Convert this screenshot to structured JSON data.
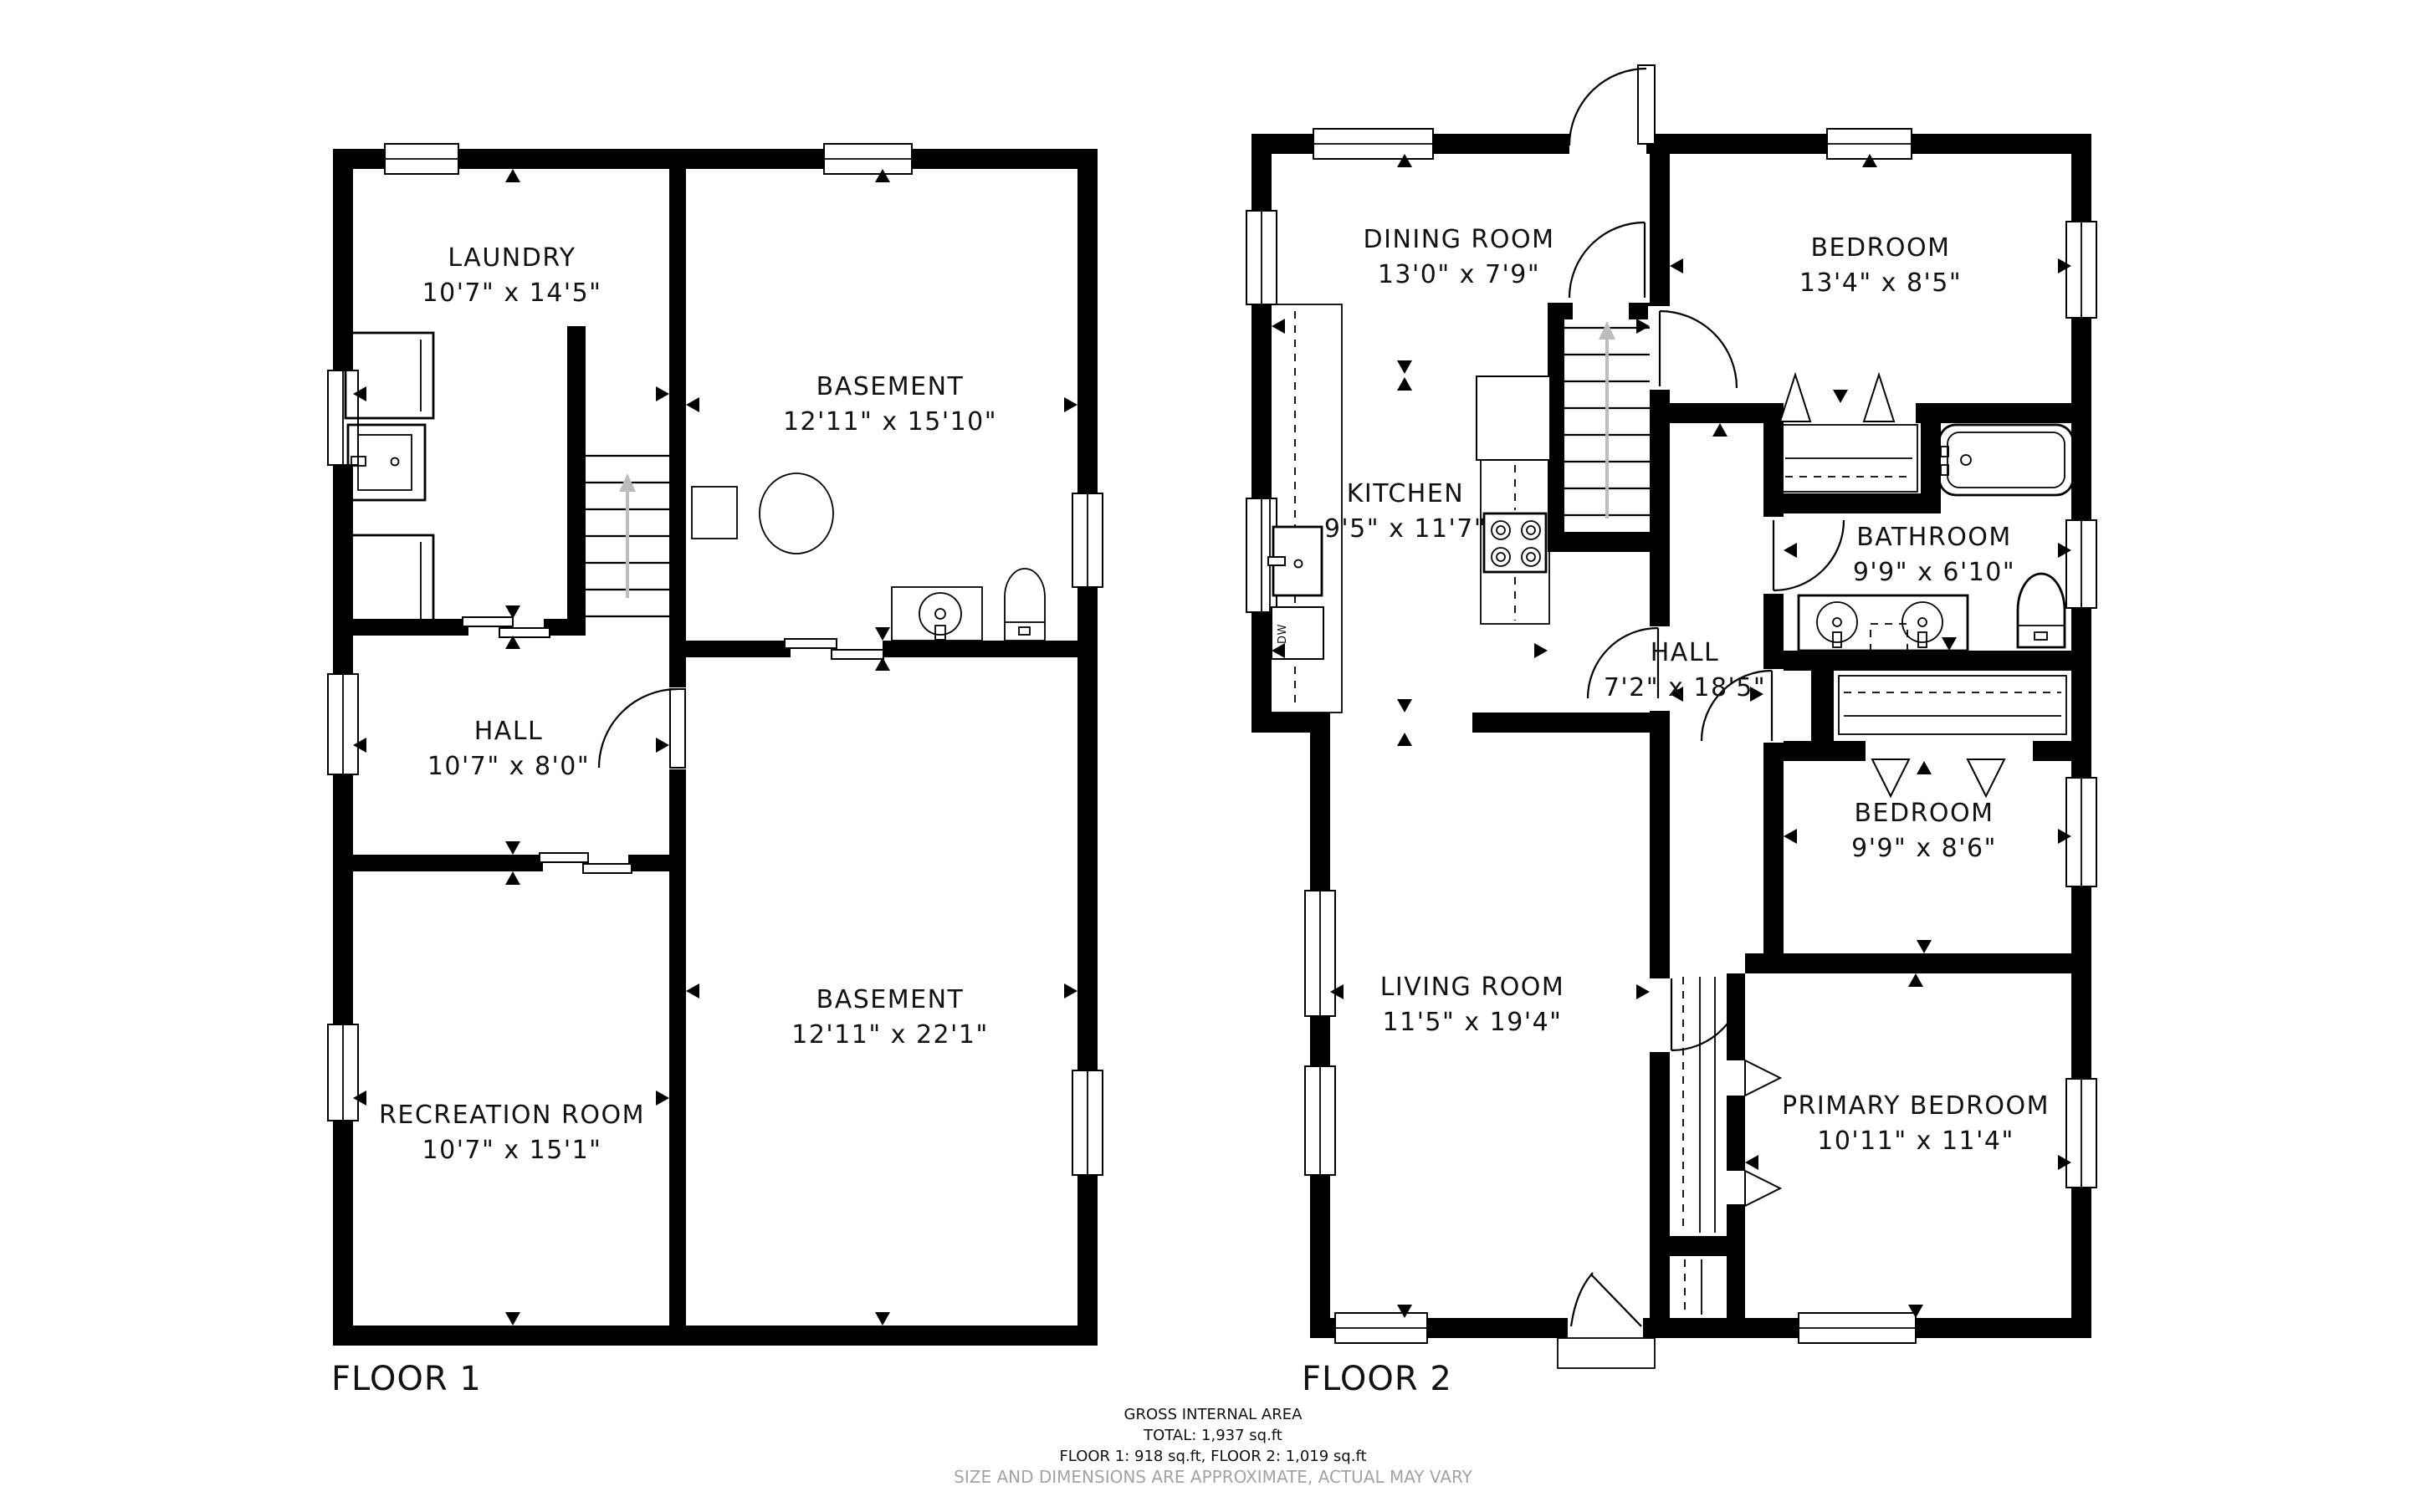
{
  "floor1": {
    "label": "FLOOR 1",
    "rooms": {
      "laundry": {
        "name": "LAUNDRY",
        "dims": "10'7\" x 14'5\""
      },
      "basement_upper": {
        "name": "BASEMENT",
        "dims": "12'11\" x 15'10\""
      },
      "hall": {
        "name": "HALL",
        "dims": "10'7\" x 8'0\""
      },
      "basement_lower": {
        "name": "BASEMENT",
        "dims": "12'11\" x 22'1\""
      },
      "recreation": {
        "name": "RECREATION ROOM",
        "dims": "10'7\" x 15'1\""
      }
    }
  },
  "floor2": {
    "label": "FLOOR 2",
    "rooms": {
      "dining": {
        "name": "DINING ROOM",
        "dims": "13'0\" x 7'9\""
      },
      "bedroom_top": {
        "name": "BEDROOM",
        "dims": "13'4\" x 8'5\""
      },
      "kitchen": {
        "name": "KITCHEN",
        "dims": "9'5\" x 11'7\""
      },
      "bathroom": {
        "name": "BATHROOM",
        "dims": "9'9\" x 6'10\""
      },
      "hall": {
        "name": "HALL",
        "dims": "7'2\" x 18'5\""
      },
      "bedroom_mid": {
        "name": "BEDROOM",
        "dims": "9'9\" x 8'6\""
      },
      "living": {
        "name": "LIVING ROOM",
        "dims": "11'5\" x 19'4\""
      },
      "primary": {
        "name": "PRIMARY BEDROOM",
        "dims": "10'11\" x 11'4\""
      }
    },
    "appliances": {
      "dishwasher": "DW"
    }
  },
  "footer": {
    "title": "GROSS INTERNAL AREA",
    "total": "TOTAL: 1,937 sq.ft",
    "floors": "FLOOR 1: 918 sq.ft, FLOOR 2: 1,019 sq.ft",
    "disclaimer": "SIZE AND DIMENSIONS ARE APPROXIMATE, ACTUAL MAY VARY"
  },
  "colors": {
    "wall": "#000000",
    "background": "#ffffff",
    "stair_arrow": "#bcbcbc",
    "disclaimer_text": "#a3a3a3"
  }
}
